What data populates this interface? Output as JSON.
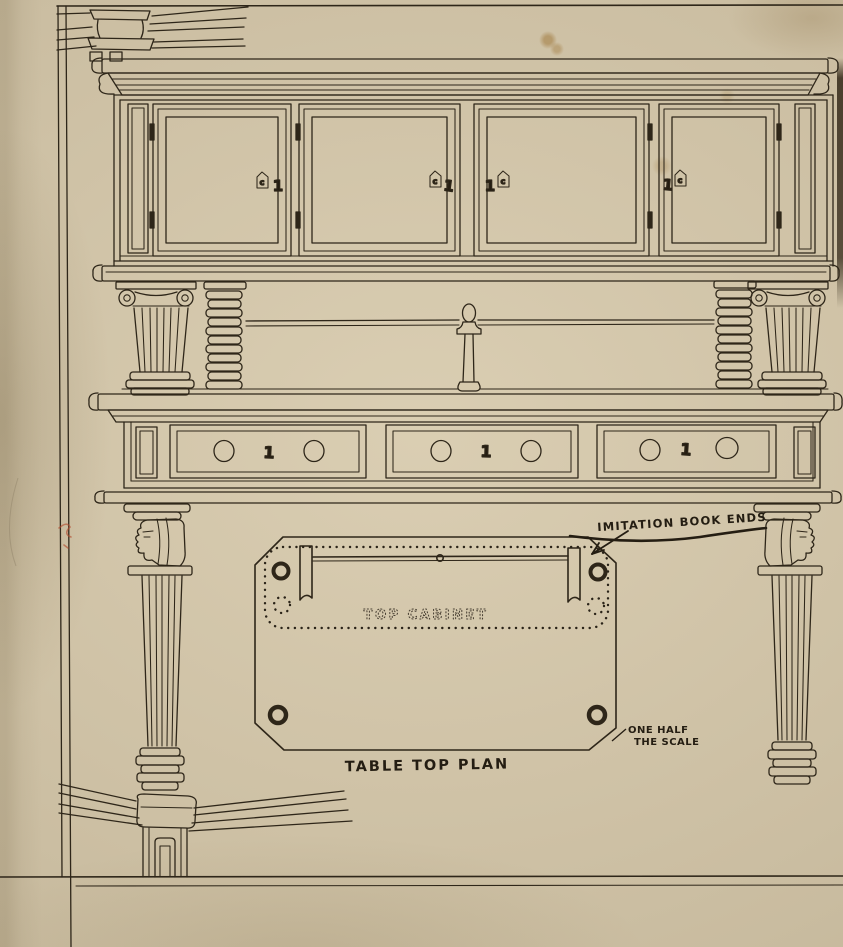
{
  "labels": {
    "imitation_book_ends": "IMITATION BOOK ENDS",
    "top_cabinet": "TOP CABINET",
    "table_top_plan": "TABLE TOP PLAN",
    "scale_line1": "ONE HALF",
    "scale_line2": "THE SCALE"
  },
  "marks": {
    "door_numbers": [
      "1",
      "1",
      "1",
      "1"
    ],
    "drawer_numbers": [
      "1",
      "1",
      "1"
    ],
    "escutcheon_letter": "c"
  },
  "colors": {
    "paper": "#d6c9ad",
    "ink": "#2e2619",
    "red_mark": "#b34a2c"
  }
}
